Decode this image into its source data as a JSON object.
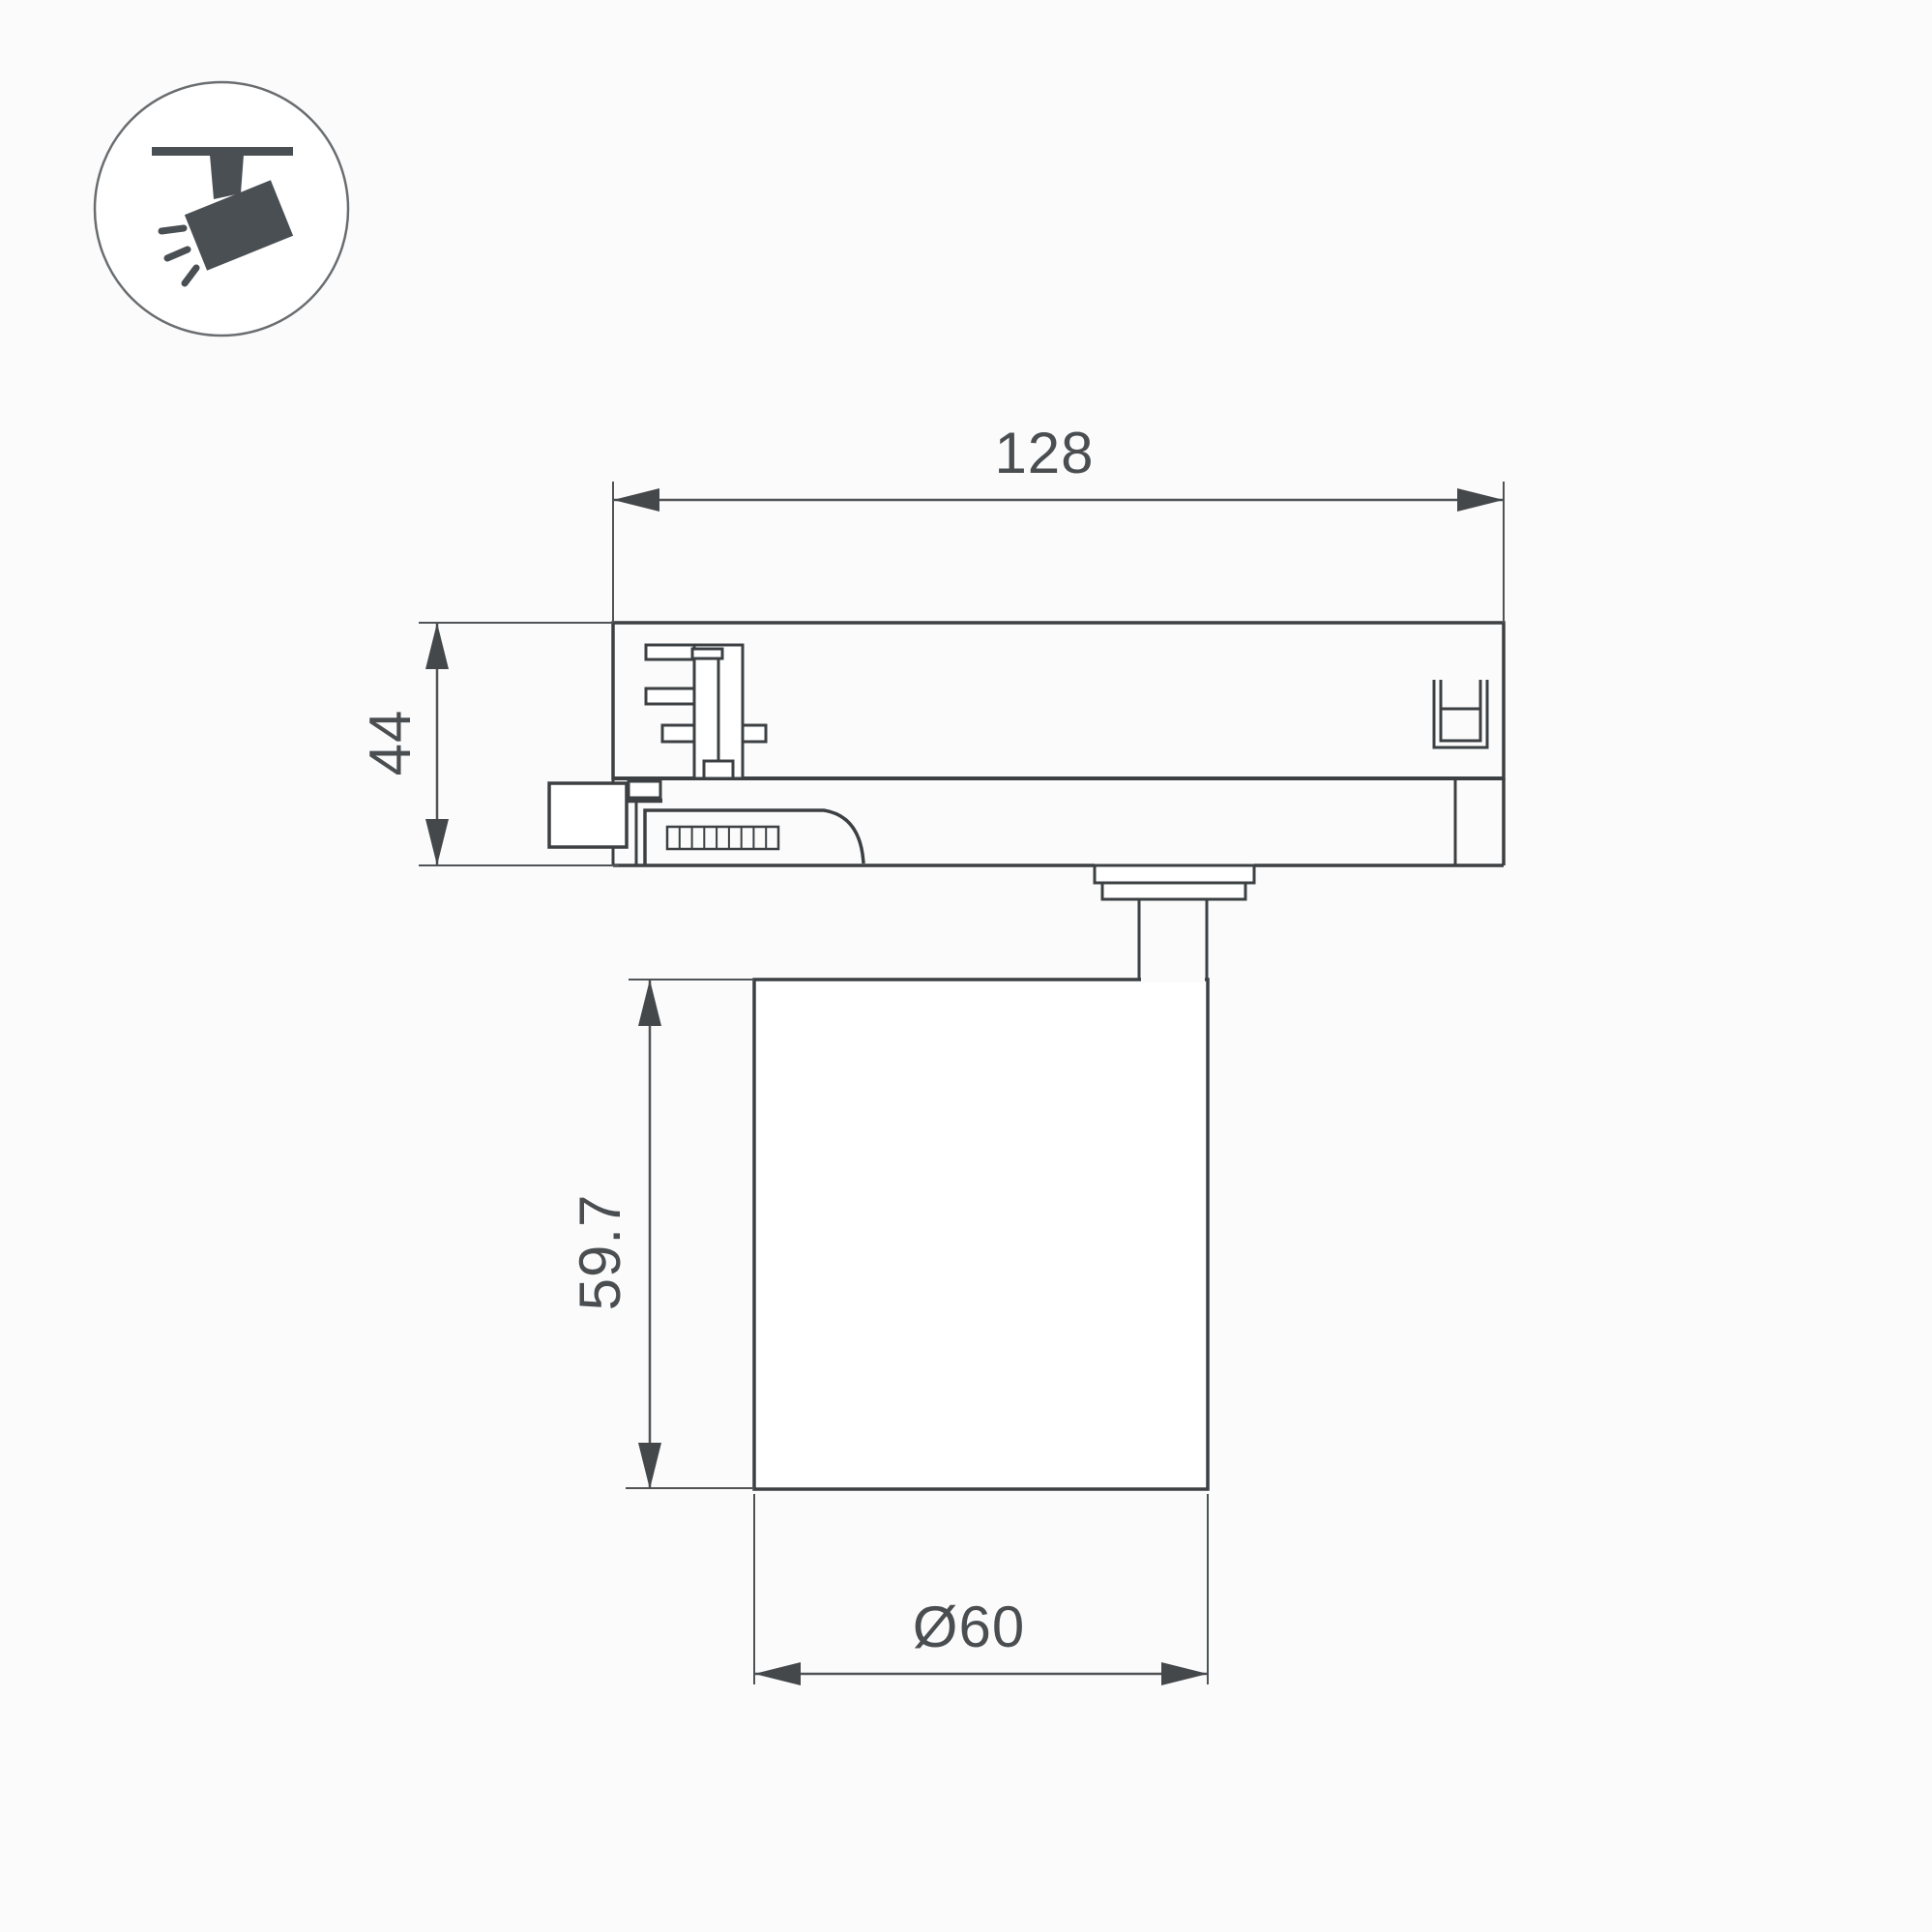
{
  "canvas": {
    "background": "#fbfbfb",
    "line_color": "#3c4043",
    "dim_color": "#4f5355",
    "icon_color": "#4a4f54"
  },
  "icon": {
    "name": "track-spotlight-icon",
    "description": "ceiling track with tilted spotlight and light rays"
  },
  "drawing": {
    "view": "side view of 3-phase track light adapter with cylindrical lamp body",
    "dimensions": {
      "width": {
        "label": "128"
      },
      "height": {
        "label": "44"
      },
      "body_height": {
        "label": "59.7"
      },
      "diameter": {
        "label": "Ø60"
      }
    }
  }
}
